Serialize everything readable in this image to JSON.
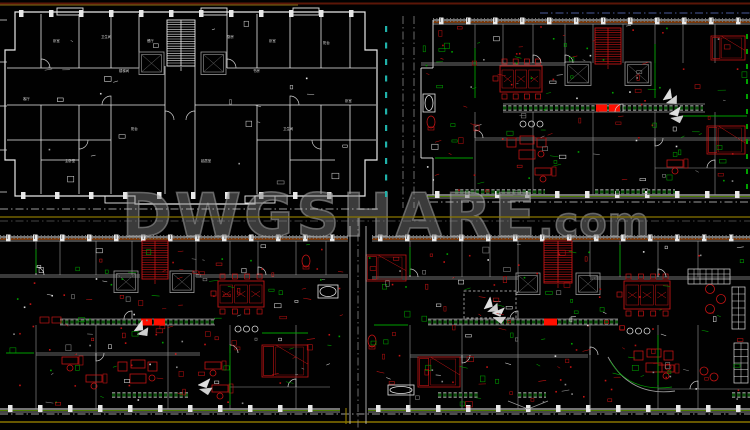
{
  "watermark": {
    "text": "DWGSHARE",
    "suffix": ".com"
  },
  "colors": {
    "background": "#000000",
    "wall_white": "#e8e8e8",
    "wall_gray": "#9a9a9a",
    "cad_green": "#00a000",
    "dark_green": "#0a500a",
    "cad_red": "#c41414",
    "highlight_red": "#ff0f00",
    "site_olive": "#8a7600",
    "site_orange": "#c05a10",
    "site_maroon": "#5c1608",
    "dim_cyan": "#20b2aa",
    "dim_blue": "#4a5a9a",
    "watermark_gray": "#9a9a9a"
  },
  "plans": [
    {
      "id": "top-left",
      "type": "unit-outline-plan",
      "room_labels": [
        "卧室",
        "卫生间",
        "餐厅",
        "厨房",
        "卧室",
        "阳台",
        "客厅",
        "楼梯间",
        "书房",
        "卧室",
        "主卧室",
        "起居室",
        "卫生间",
        "阳台"
      ]
    },
    {
      "id": "top-right",
      "type": "furnished-plan"
    },
    {
      "id": "bottom-left",
      "type": "furnished-plan"
    },
    {
      "id": "bottom-right",
      "type": "furnished-plan"
    }
  ]
}
